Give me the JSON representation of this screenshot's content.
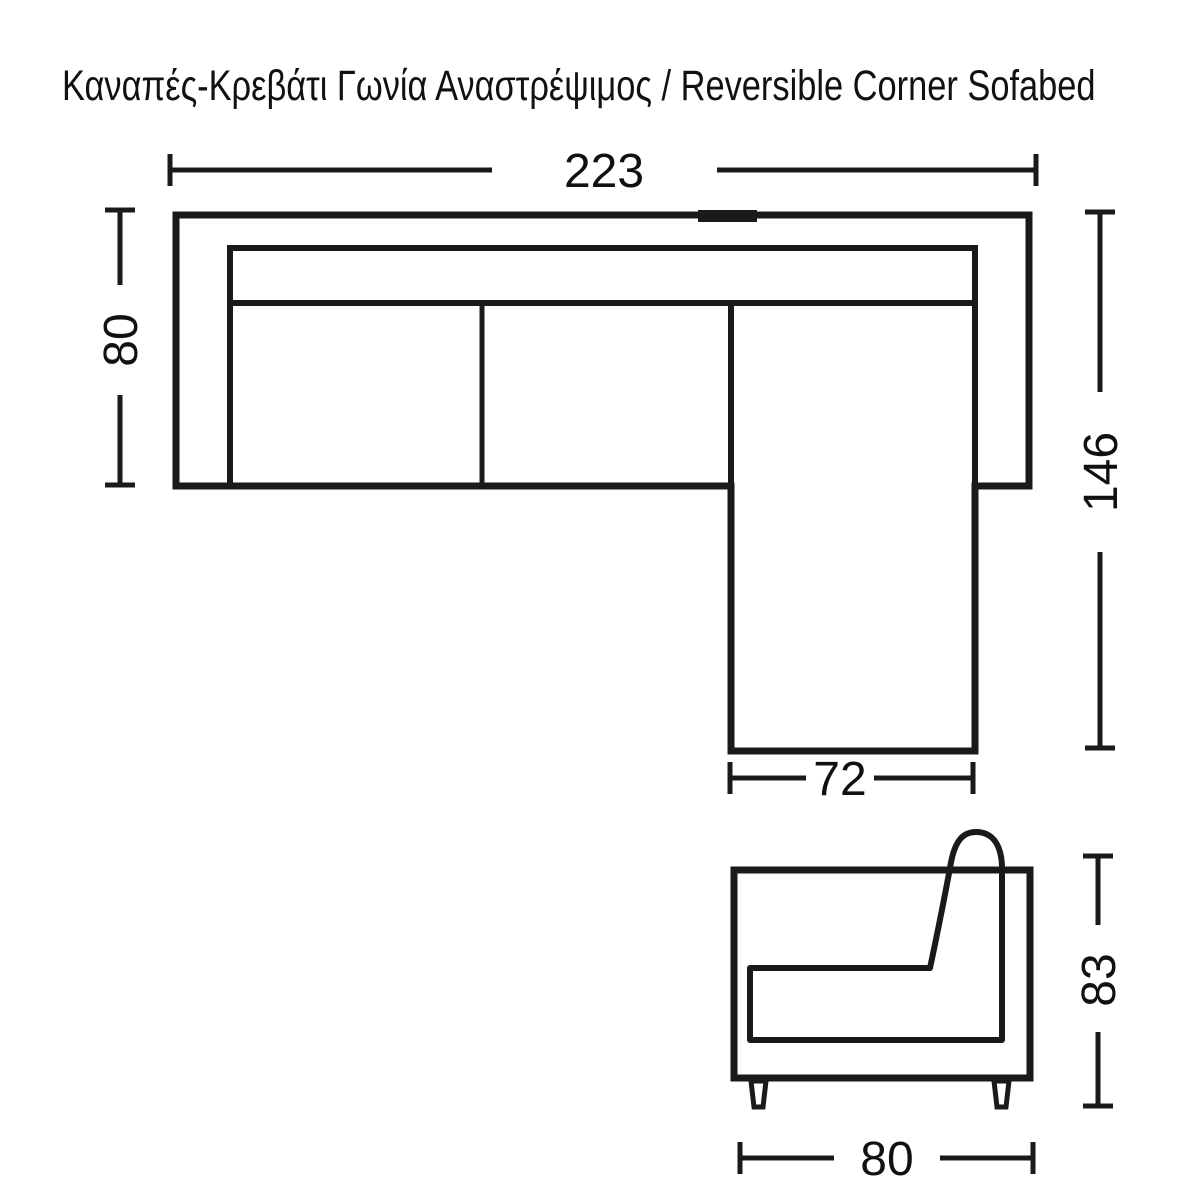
{
  "title": "Καναπές-Κρεβάτι Γωνία Αναστρέψιμος / Reversible Corner Sofabed",
  "colors": {
    "outline": "#1a1a1a",
    "frame_gray": "#c1c2c6",
    "backrest_gray": "#dadbde",
    "cushion_white": "#ffffff",
    "background": "#ffffff",
    "text": "#111111"
  },
  "top_view": {
    "overall_width_cm": "223",
    "depth_cm": "80",
    "chaise_length_cm": "146",
    "chaise_width_cm": "72"
  },
  "side_view": {
    "height_cm": "83",
    "depth_cm": "80"
  }
}
